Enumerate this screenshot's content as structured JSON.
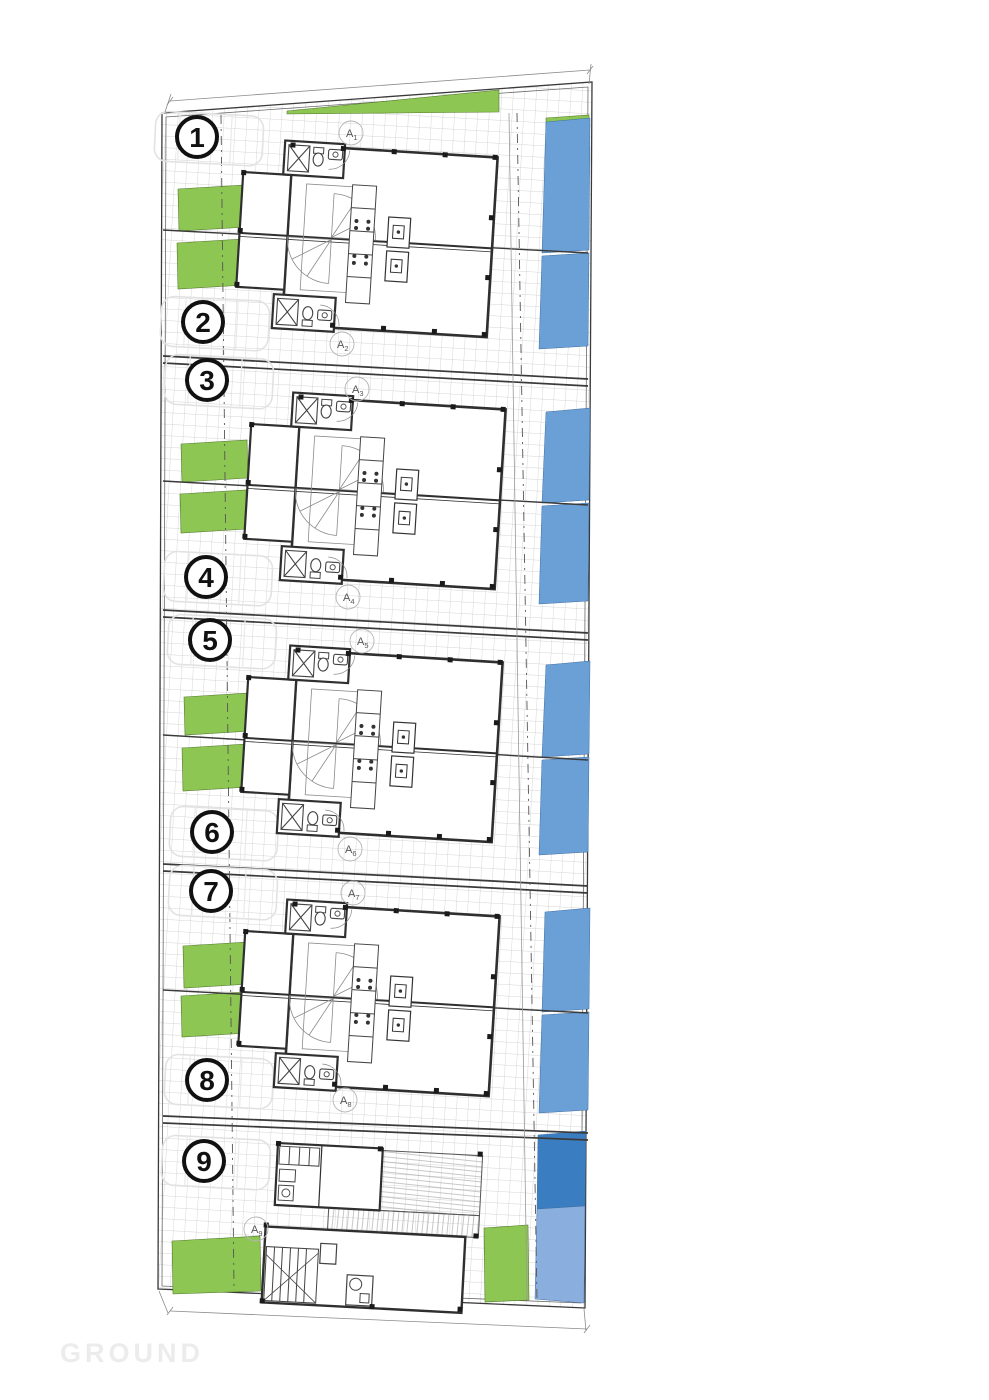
{
  "drawing": {
    "floor_label": "GROUND",
    "plot_numbers": [
      "1",
      "2",
      "3",
      "4",
      "5",
      "6",
      "7",
      "8",
      "9"
    ],
    "unit_labels": [
      {
        "letter": "A",
        "sub": "1"
      },
      {
        "letter": "A",
        "sub": "2"
      },
      {
        "letter": "A",
        "sub": "3"
      },
      {
        "letter": "A",
        "sub": "4"
      },
      {
        "letter": "A",
        "sub": "5"
      },
      {
        "letter": "A",
        "sub": "6"
      },
      {
        "letter": "A",
        "sub": "7"
      },
      {
        "letter": "A",
        "sub": "8"
      },
      {
        "letter": "A",
        "sub": "9"
      }
    ],
    "colors": {
      "garden_green": "#8dc653",
      "pool_blue": "#6ba0d6",
      "pool_dark_blue": "#3a7ec1",
      "pool_light_blue": "#8aaedd",
      "ground_text": "#ececec"
    }
  }
}
